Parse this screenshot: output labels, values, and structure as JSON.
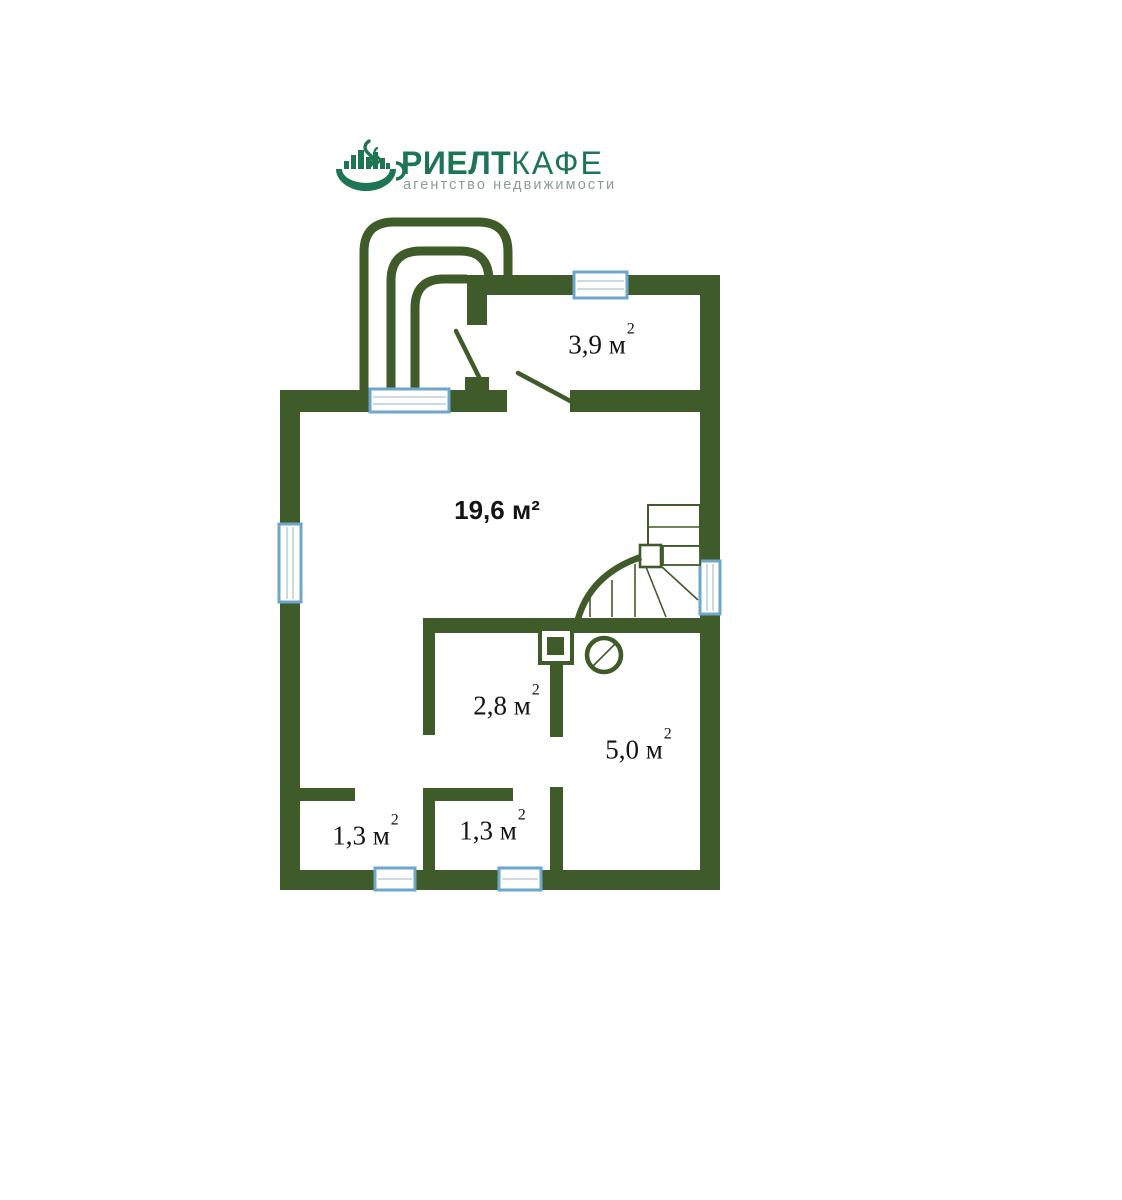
{
  "logo": {
    "title_bold": "РИЕЛТ",
    "title_light": "КАФЕ",
    "subtitle": "агентство недвижимости",
    "brand_color": "#1e7553",
    "subtitle_color": "#8d9c96"
  },
  "floorplan": {
    "wall_color": "#3f5b29",
    "window_frame_color": "#6ea6cc",
    "rooms": [
      {
        "name": "entry-hall",
        "label": "3,9 м",
        "sup": "2"
      },
      {
        "name": "living-room",
        "label": "19,6 м²"
      },
      {
        "name": "corridor",
        "label": "2,8 м",
        "sup": "2"
      },
      {
        "name": "bathroom",
        "label": "5,0 м",
        "sup": "2"
      },
      {
        "name": "closet-left",
        "label": "1,3 м",
        "sup": "2"
      },
      {
        "name": "closet-middle",
        "label": "1,3 м",
        "sup": "2"
      }
    ]
  }
}
